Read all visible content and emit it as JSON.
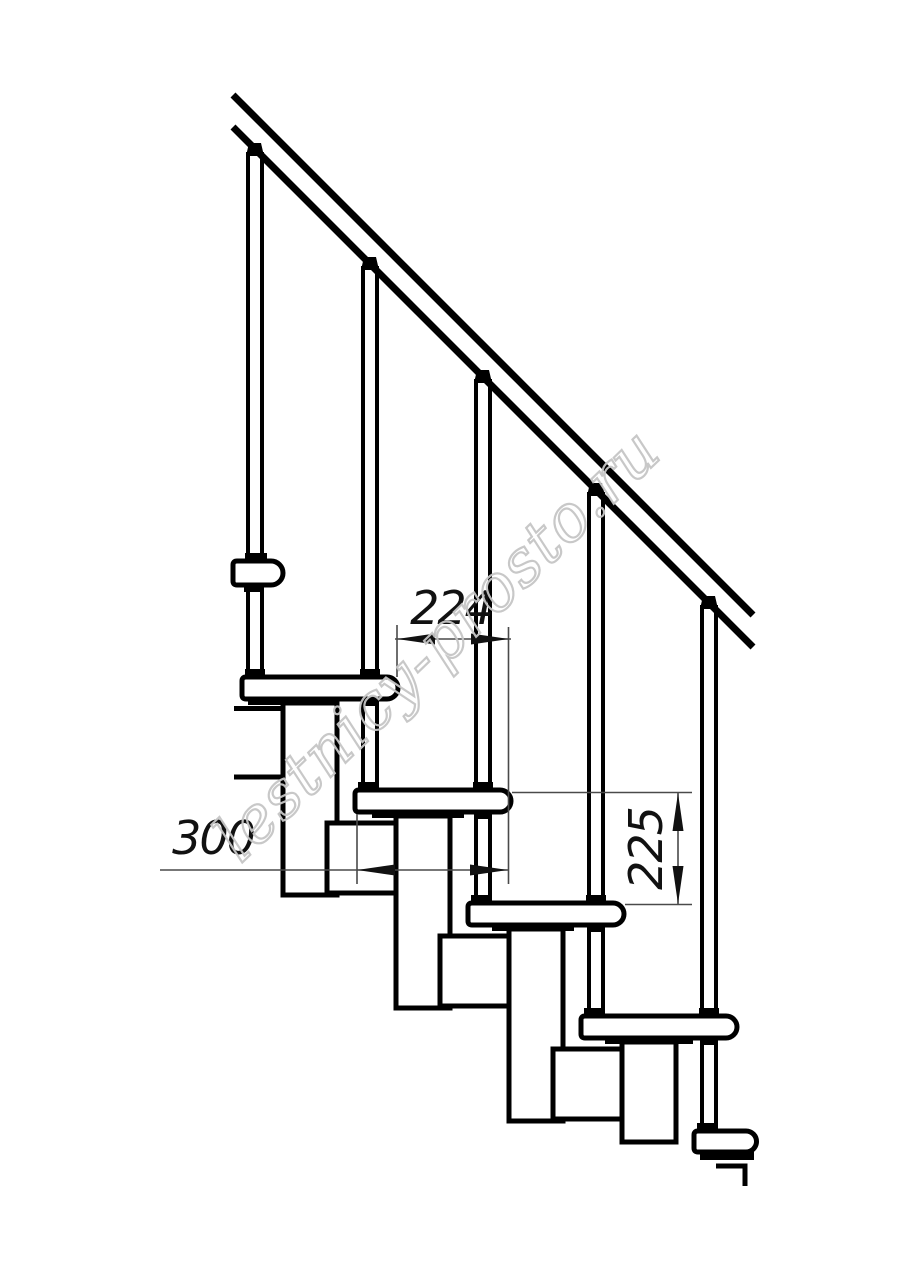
{
  "drawing": {
    "title": "modular-staircase-side-elevation",
    "colors": {
      "line": "#000000",
      "background": "#ffffff",
      "dimension_text": "#111111"
    },
    "dimensions": {
      "tread_overlap_run": {
        "value": "224",
        "orientation": "horizontal"
      },
      "tread_depth": {
        "value": "300",
        "orientation": "horizontal"
      },
      "step_rise": {
        "value": "225",
        "orientation": "vertical"
      }
    },
    "watermark": {
      "text": "lestnicy-prosto.ru",
      "color": "#c6c6c6"
    }
  }
}
